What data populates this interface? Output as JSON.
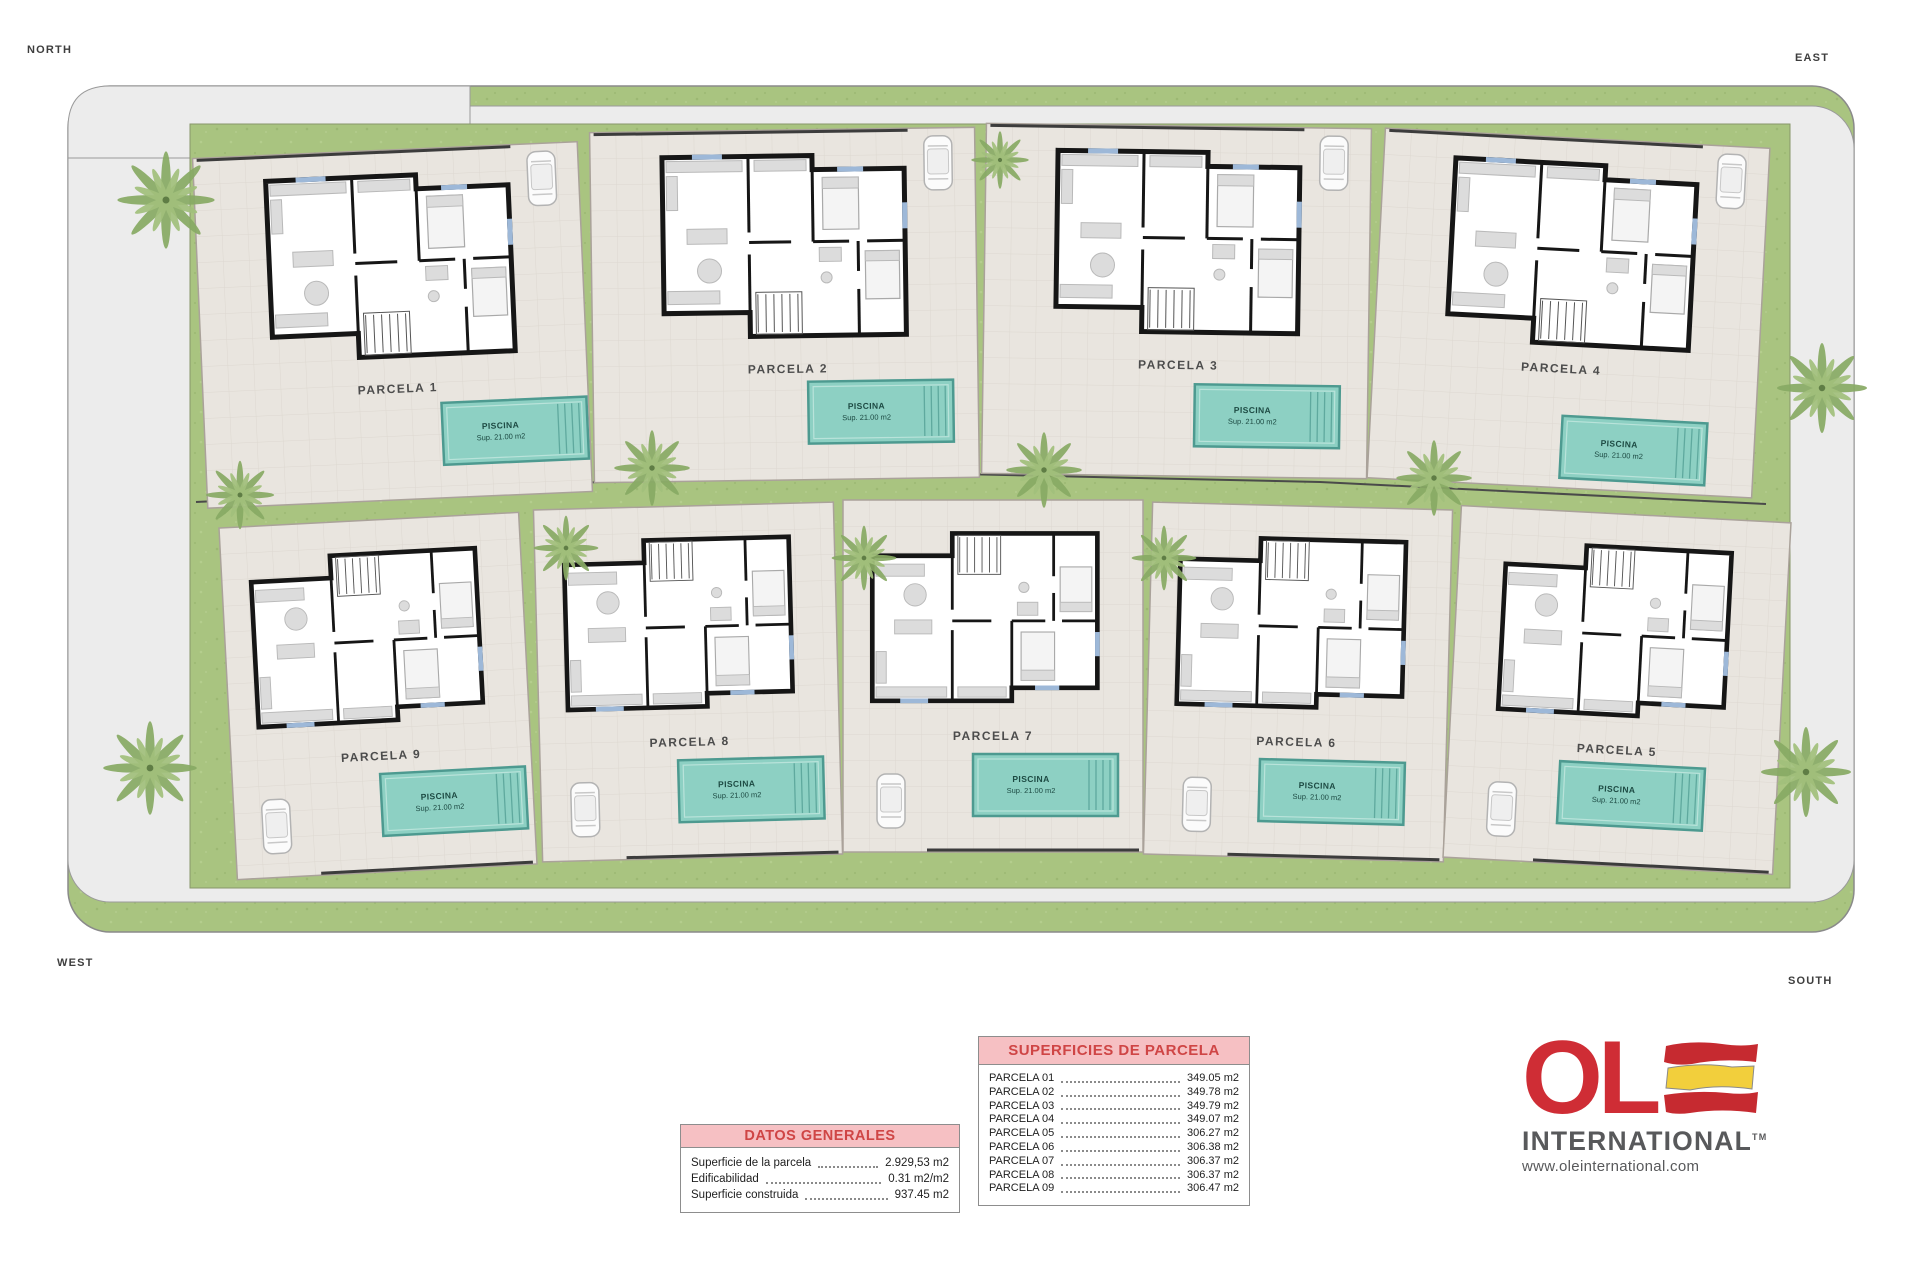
{
  "compass": {
    "north": "NORTH",
    "east": "EAST",
    "west": "WEST",
    "south": "SOUTH"
  },
  "parcels": [
    {
      "label": "PARCELA 1"
    },
    {
      "label": "PARCELA 2"
    },
    {
      "label": "PARCELA 3"
    },
    {
      "label": "PARCELA 4"
    },
    {
      "label": "PARCELA 5"
    },
    {
      "label": "PARCELA 6"
    },
    {
      "label": "PARCELA 7"
    },
    {
      "label": "PARCELA 8"
    },
    {
      "label": "PARCELA 9"
    }
  ],
  "pool": {
    "name": "PISCINA",
    "sup": "Sup. 21.00 m2"
  },
  "tables": {
    "superficies": {
      "title": "SUPERFICIES DE PARCELA",
      "rows": [
        {
          "label": "PARCELA 01",
          "value": "349.05 m2"
        },
        {
          "label": "PARCELA 02",
          "value": "349.78 m2"
        },
        {
          "label": "PARCELA 03",
          "value": "349.79 m2"
        },
        {
          "label": "PARCELA 04",
          "value": "349.07 m2"
        },
        {
          "label": "PARCELA 05",
          "value": "306.27 m2"
        },
        {
          "label": "PARCELA 06",
          "value": "306.38 m2"
        },
        {
          "label": "PARCELA 07",
          "value": "306.37 m2"
        },
        {
          "label": "PARCELA 08",
          "value": "306.37 m2"
        },
        {
          "label": "PARCELA 09",
          "value": "306.47 m2"
        }
      ]
    },
    "datos": {
      "title": "DATOS GENERALES",
      "rows": [
        {
          "label": "Superficie de la parcela",
          "value": "2.929,53 m2"
        },
        {
          "label": "Edificabilidad",
          "value": "0.31 m2/m2"
        },
        {
          "label": "Superficie construida",
          "value": "937.45 m2"
        }
      ]
    }
  },
  "logo": {
    "ol": "OL",
    "international": "INTERNATIONAL",
    "tm": "TM",
    "url": "www.oleinternational.com"
  },
  "colors": {
    "pool": "#8dd0c3",
    "grass": "#a9c480",
    "road": "#ececec",
    "plot": "#e9e5df",
    "pink": "#f6c0c3",
    "table_red": "#cf4545",
    "logo_red": "#cf2d35",
    "flag_yellow": "#f2cf3c"
  }
}
